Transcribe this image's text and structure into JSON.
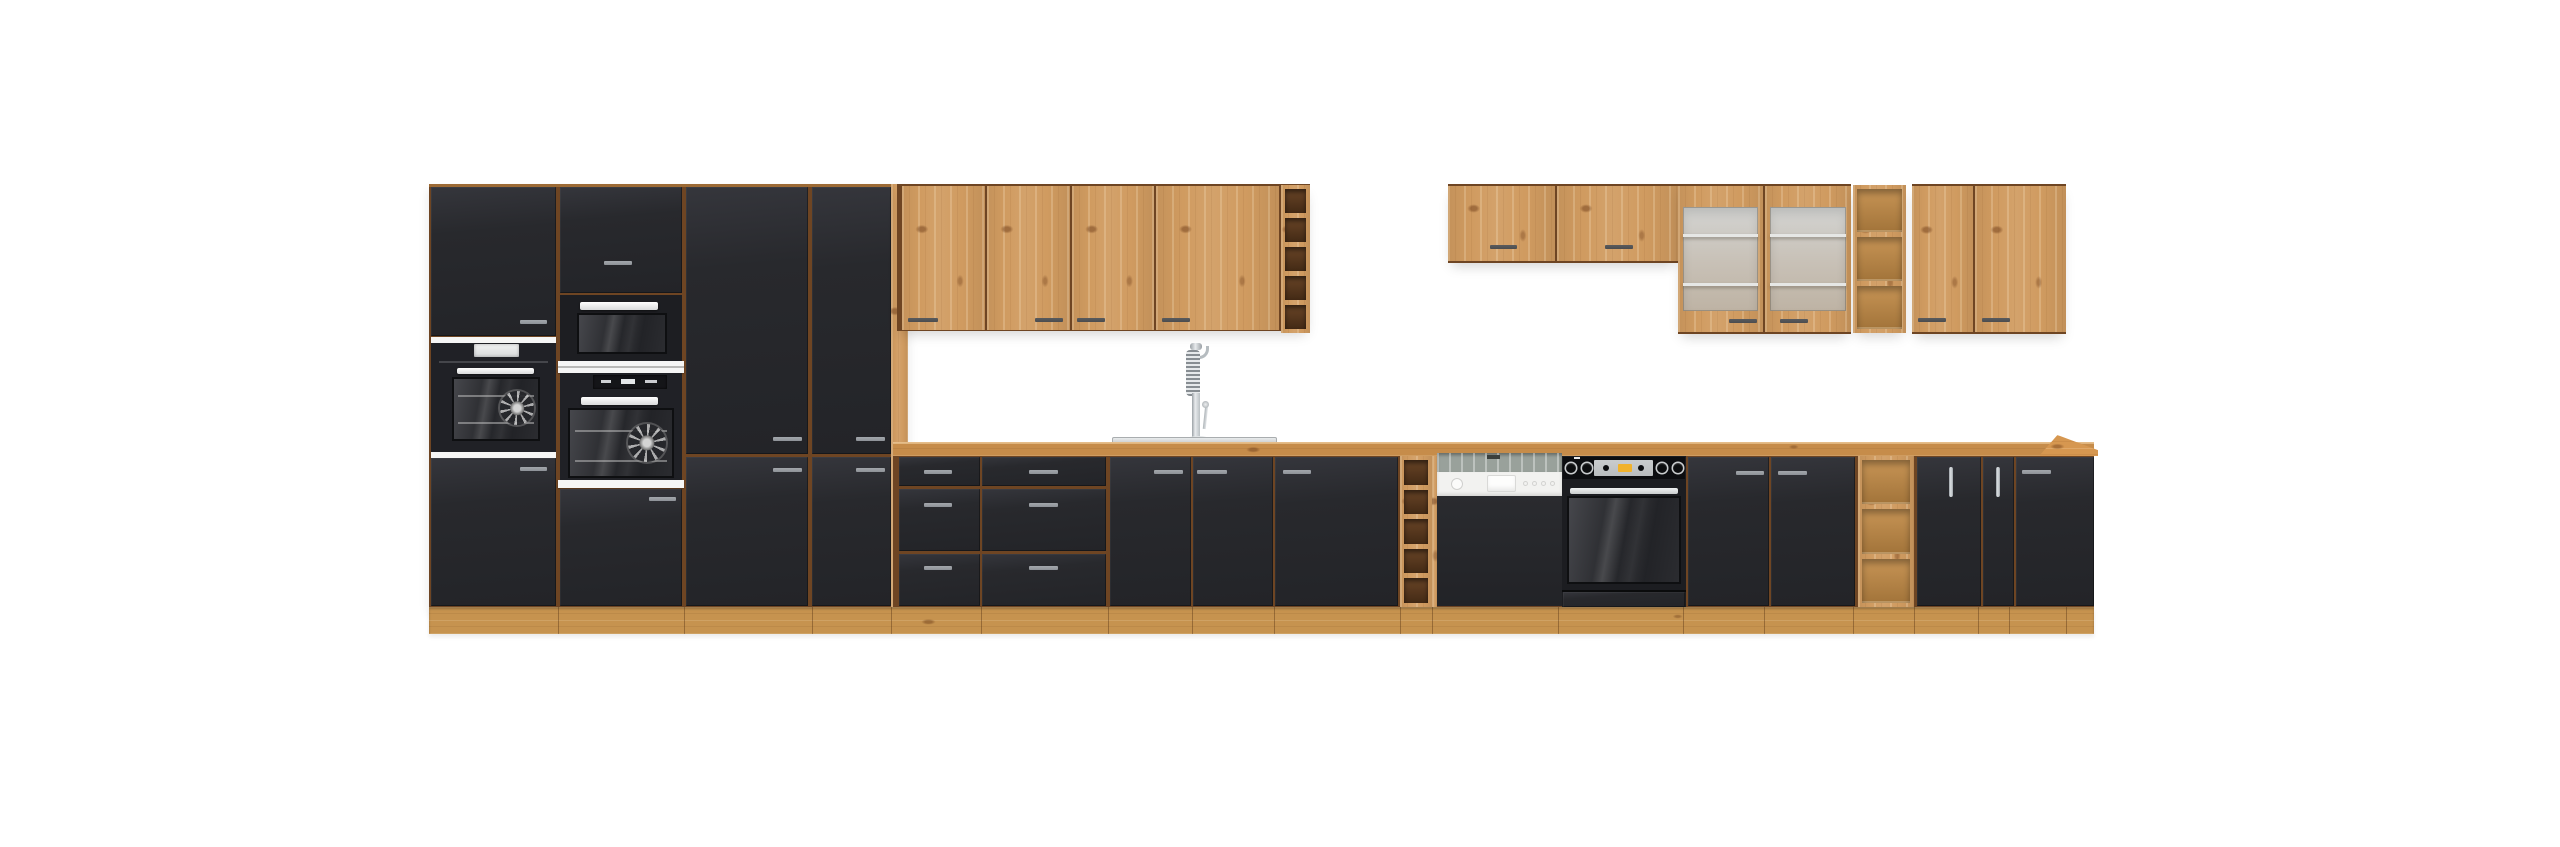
{
  "image": {
    "kind": "product-photo",
    "description": "Modular kitchen furniture set with matte black fronts, artisan oak carcass, worktop, plinth and open wine shelves, photographed on a plain white background",
    "background": "#ffffff"
  },
  "colors": {
    "oak": "#d09b60",
    "oak_light": "#dcae79",
    "oak_shade": "#b9813f",
    "counter": "#c68c4a",
    "plinth": "#c6934f",
    "seam": "#6e4523",
    "cubby": "#4e3018",
    "front": "#28292d",
    "front_hi": "#35363c",
    "edge": "#17181b",
    "handle_dark": "#4b4c4e",
    "handle_gray": "#8e9297",
    "chrome": "#c3c7ca",
    "white_strip": "#f6f6f5",
    "dw_fascia": "#f2f2f0",
    "dw_band": "#99a19b",
    "frost_top": "#d3d4d2",
    "frost_mid": "#c8c1b7",
    "frost_low": "#beb3a4",
    "oven_glass": "#303136",
    "display_silver": "#babdbf",
    "display_yellow": "#f1b22c",
    "wall": "#ffffff"
  },
  "inventory": {
    "tall_unit": {
      "columns": 4,
      "appliances": [
        "built-in oven with white display",
        "compact oven",
        "built-in oven with clock display"
      ],
      "black_doors": 8
    },
    "upper_left_cabinets": {
      "oak_doors": 4
    },
    "sink_area": {
      "sink": "inset stainless sink",
      "faucet": "chrome spring pull-down mixer tap"
    },
    "base_run": {
      "drawer_units": 2,
      "drawers_per_unit": 3,
      "sink_doors": 2,
      "wide_doors": 2,
      "right_doors": 3,
      "vertical_handle_doors": 2
    },
    "appliances": {
      "dishwasher": "semi-integrated, white control fascia with buttons",
      "oven": "built-in black oven with 4 knobs and amber display"
    },
    "upper_right_cabinets": {
      "short_cabinet_doors": 2,
      "glass_display_doors": 2,
      "tall_doors": 2
    }
  },
  "counts": {
    "upper_wine_cubbies": 5,
    "base_wine_cubbies": 5,
    "upper_open_shelves": 3,
    "base_open_shelves": 3
  }
}
